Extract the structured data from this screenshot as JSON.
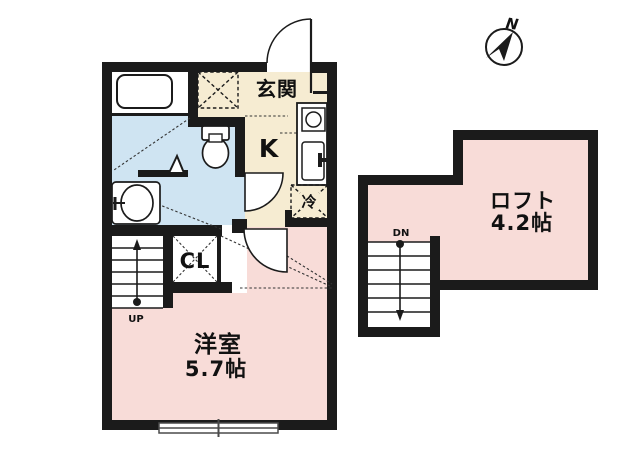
{
  "plan": {
    "entrance_label": "玄関",
    "kitchen_label": "K",
    "fridge_label": "冷",
    "closet_label": "CL",
    "main_room_label": "洋室",
    "main_room_size": "5.7帖",
    "loft_label": "ロフト",
    "loft_size": "4.2帖",
    "stairs_up_label": "UP",
    "stairs_down_label": "DN",
    "compass_north_label": "N"
  },
  "colors": {
    "wall": "#1b1b1b",
    "room_floor_pink": "#f8dcd8",
    "wet_area_blue": "#cfe4f2",
    "entry_floor_cream": "#f6ecd2",
    "line_dark": "#1b1b1b",
    "window_gray": "#4a4a4a"
  }
}
